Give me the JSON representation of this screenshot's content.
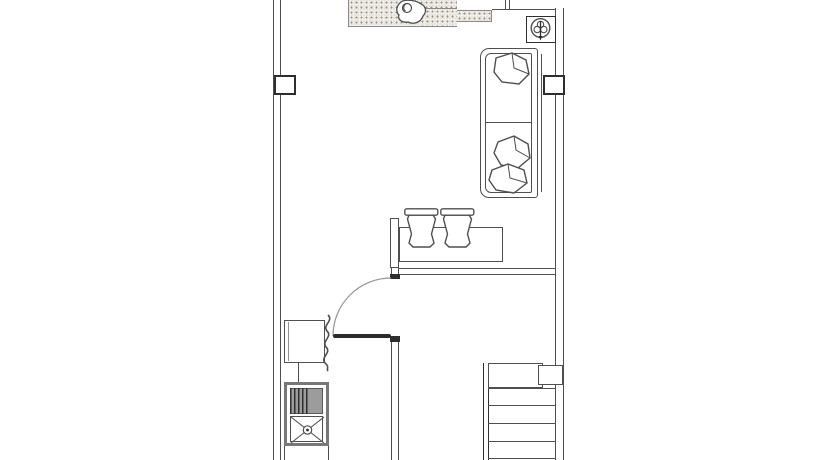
{
  "title": "Residential unit floor plan - CAD line drawing, no text labels",
  "canvas": {
    "width": 840,
    "height": 460
  },
  "colors": {
    "background": "#ffffff",
    "line": "#4f4f4f",
    "line_dark": "#2e2e2e",
    "line_light": "#949494",
    "gray_fill": "#9c9c9c",
    "stipple_dot": "#9a9186",
    "hatch_border": "#8a8a8a",
    "door_leaf": "#2b2b2b"
  },
  "legend": {
    "counter_hatch": "stippled countertop band along top wall",
    "counter_decor": "decorative vessel on countertop",
    "plant_symbol": "potted-plant symbol in square planter box",
    "sofa": "two-seat sofa against right wall with three cushions",
    "bar_counter": "bar counter with end panel",
    "stools": "two bar stools at counter",
    "door": "swing door with quarter-circle arc",
    "washer": "appliance box with flexible hose squiggle",
    "sink_unit": "sink with striped drainboard and X floor-drain basin",
    "staircase": "staircase with landing and treads",
    "walls": "double-line exterior walls with piers"
  }
}
